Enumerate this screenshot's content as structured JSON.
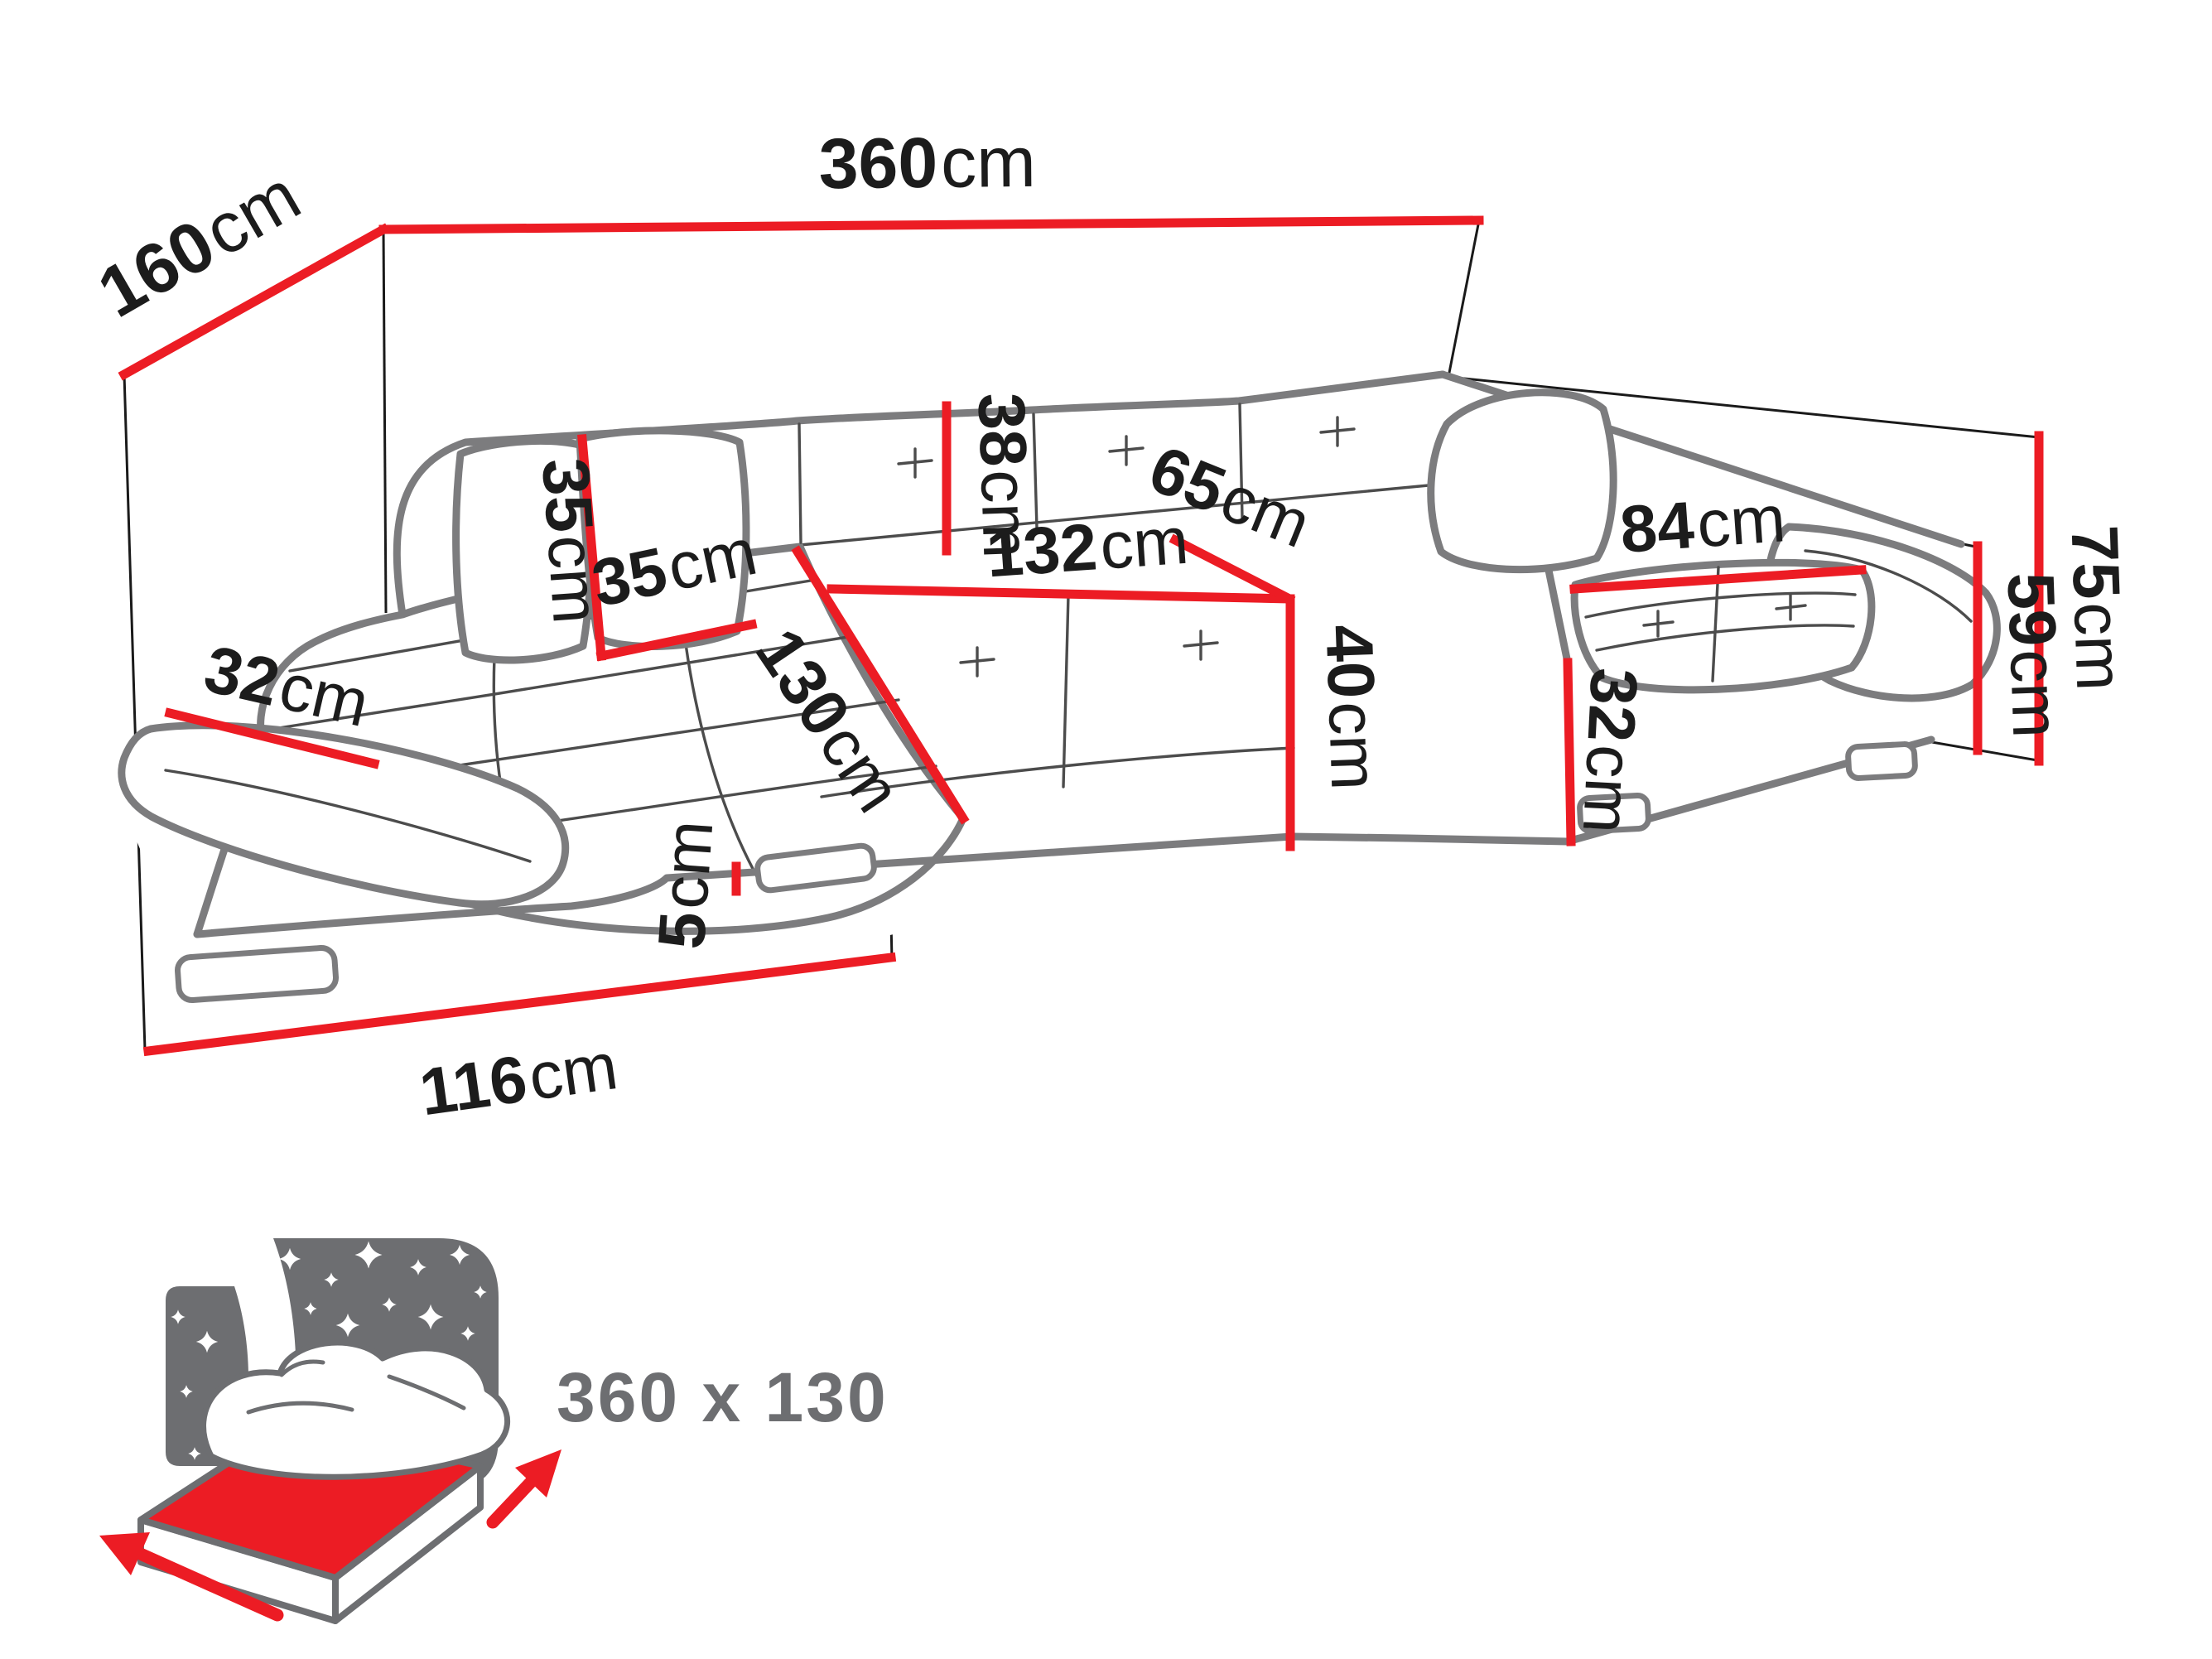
{
  "diagram": {
    "title_hint": "U-shaped corner sofa dimension drawing",
    "dims": {
      "total_width": {
        "value": "360",
        "unit": "cm"
      },
      "depth_left": {
        "value": "160",
        "unit": "cm"
      },
      "pillow_height": {
        "value": "35",
        "unit": "cm"
      },
      "pillow_width": {
        "value": "35",
        "unit": "cm"
      },
      "back_cushion_height": {
        "value": "38",
        "unit": "cm"
      },
      "middle_seat_width": {
        "value": "132",
        "unit": "cm"
      },
      "seat_depth": {
        "value": "65",
        "unit": "cm"
      },
      "seat_height": {
        "value": "40",
        "unit": "cm"
      },
      "right_chaise_width": {
        "value": "84",
        "unit": "cm"
      },
      "total_height": {
        "value": "75",
        "unit": "cm"
      },
      "armrest_height": {
        "value": "59",
        "unit": "cm"
      },
      "left_armrest_depth": {
        "value": "32",
        "unit": "cm"
      },
      "right_base_height": {
        "value": "32",
        "unit": "cm"
      },
      "left_chaise_length": {
        "value": "130",
        "unit": "cm"
      },
      "leg_height": {
        "value": "5",
        "unit": "cm"
      },
      "left_chaise_depth": {
        "value": "116",
        "unit": "cm"
      }
    },
    "sleeping_area": {
      "label": "360 x 130"
    },
    "colors": {
      "dimension_red": "#ec1c24",
      "outline_gray": "#7c7c7e",
      "text_black": "#1c1c1c",
      "icon_gray": "#6d6e71"
    }
  }
}
